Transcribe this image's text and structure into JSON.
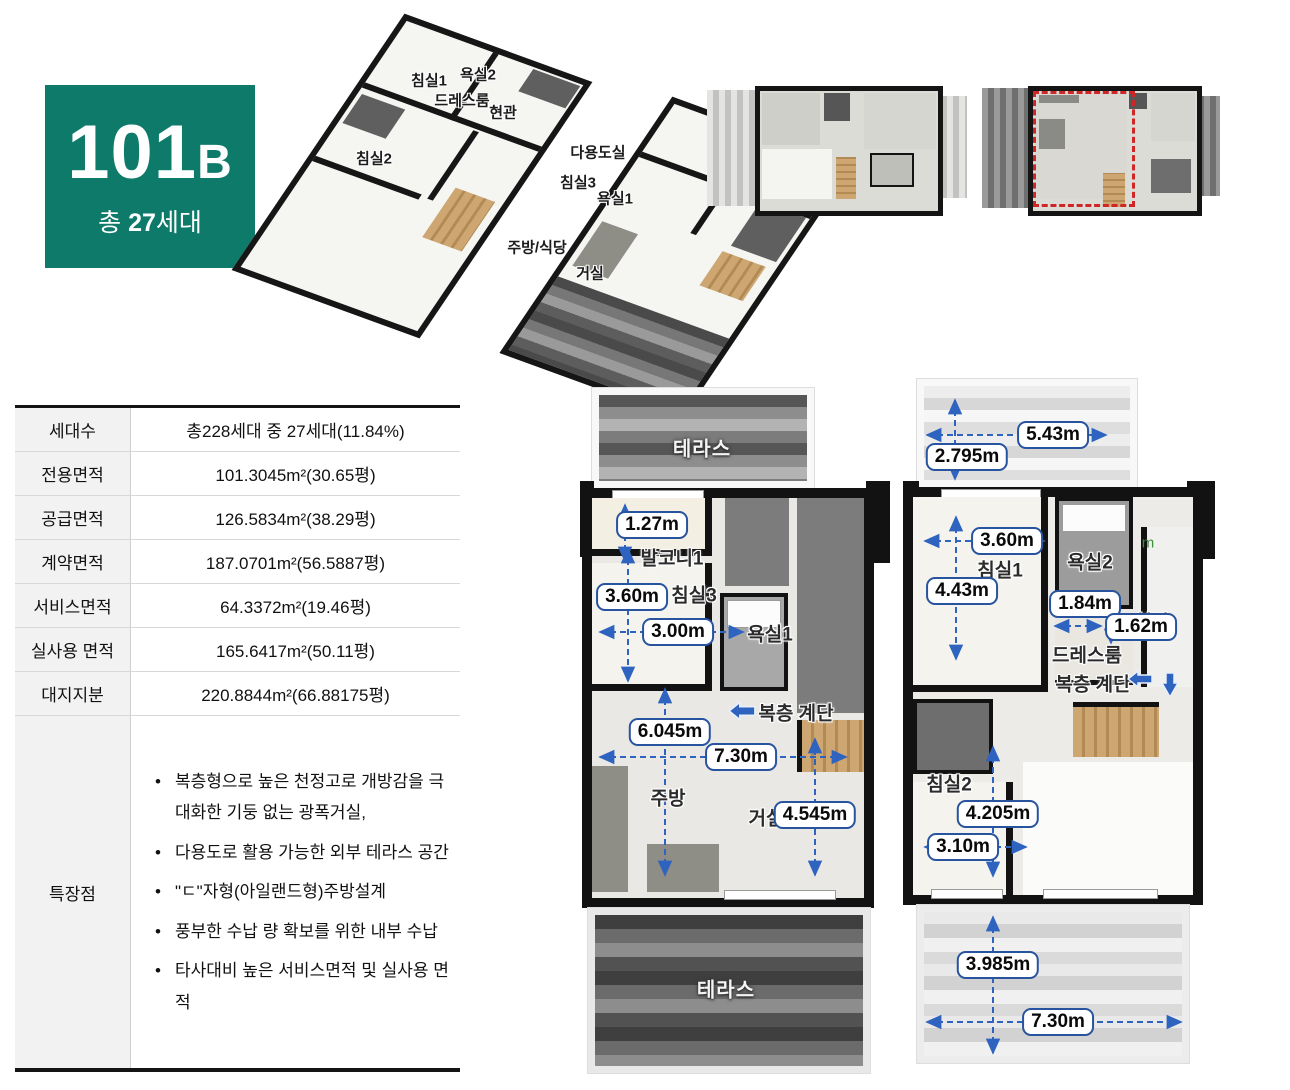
{
  "badge": {
    "number": "101",
    "suffix": "B",
    "total_prefix": "총 ",
    "total_count": "27",
    "total_suffix": "세대",
    "bg_color": "#0e7a6a"
  },
  "iso3d": {
    "upper": {
      "bedroom1": "침실1",
      "bath2": "욕실2",
      "dressroom": "드레스룸",
      "entrance": "현관",
      "bedroom2": "침실2"
    },
    "lower": {
      "utility": "다용도실",
      "bedroom3": "침실3",
      "bath1": "욕실1",
      "kitchen_dining": "주방/식당",
      "living": "거실"
    }
  },
  "info_table": {
    "rows": [
      {
        "label": "세대수",
        "value": "총228세대 중 27세대(11.84%)"
      },
      {
        "label": "전용면적",
        "value": "101.3045m²(30.65평)"
      },
      {
        "label": "공급면적",
        "value": "126.5834m²(38.29평)"
      },
      {
        "label": "계약면적",
        "value": "187.0701m²(56.5887평)"
      },
      {
        "label": "서비스면적",
        "value": "64.3372m²(19.46평)"
      },
      {
        "label": "실사용 면적",
        "value": "165.6417m²(50.11평)"
      },
      {
        "label": "대지지분",
        "value": "220.8844m²(66.88175평)"
      }
    ],
    "features_label": "특장점",
    "features": [
      "복층형으로 높은 천정고로 개방감을 극대화한 기둥 없는 광폭거실,",
      "다용도로 활용 가능한 외부 테라스 공간",
      "\"ㄷ\"자형(아일랜드형)주방설계",
      "풍부한 수납 량 확보를 위한 내부 수납",
      "타사대비 높은 서비스면적 및 실사용 면적"
    ]
  },
  "plan_lower": {
    "terrace_top": "테라스",
    "terrace_bottom": "테라스",
    "rooms": {
      "balcony1": "발코니1",
      "bedroom3": "침실3",
      "bath1": "욕실1",
      "stairs": "복층 계단",
      "kitchen": "주방",
      "living": "거실"
    },
    "dims": {
      "balcony_h": "1.27m",
      "bed3_h": "3.60m",
      "bed3_w": "3.00m",
      "mid_h": "6.045m",
      "width": "7.30m",
      "living_h": "4.545m"
    }
  },
  "plan_upper": {
    "rooms": {
      "bedroom1": "침실1",
      "bath2": "욕실2",
      "entrance": "현관",
      "dressroom": "드레스룸",
      "stairs": "복층 계단",
      "bedroom2": "침실2"
    },
    "watermark": "m",
    "dims": {
      "terrace_top_w": "5.43m",
      "terrace_top_h": "2.795m",
      "bed1_w": "3.60m",
      "bed1_h": "4.43m",
      "dress_w": "1.84m",
      "entry_w": "1.62m",
      "bed2_h": "4.205m",
      "bed2_w": "3.10m",
      "terrace_bottom_h": "3.985m",
      "terrace_bottom_w": "7.30m"
    }
  },
  "colors": {
    "accent_green": "#0e7a6a",
    "dim_blue": "#2f63c0",
    "dim_border": "#28539f",
    "highlight_red": "#cf2626"
  }
}
